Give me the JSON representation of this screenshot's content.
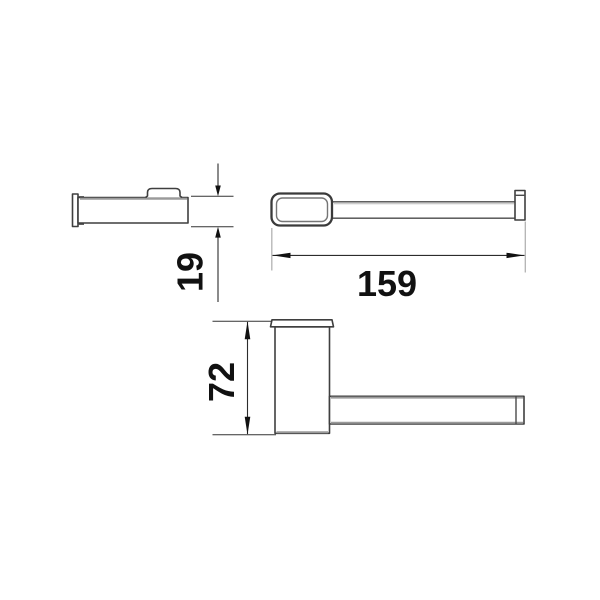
{
  "drawing": {
    "type": "technical-dimension-drawing",
    "views": [
      {
        "id": "side-view",
        "description": "side profile of wall bracket with arm"
      },
      {
        "id": "top-view",
        "description": "top view of holder bar with mount plate and end stop"
      },
      {
        "id": "front-view",
        "description": "front view of mount post with horizontal bar"
      }
    ],
    "dimensions": [
      {
        "label": "19",
        "view": "side-view",
        "text_orientation": "rotated-90"
      },
      {
        "label": "159",
        "view": "top-view",
        "text_orientation": "horizontal"
      },
      {
        "label": "72",
        "view": "front-view",
        "text_orientation": "rotated-90"
      }
    ],
    "colors": {
      "background": "#ffffff",
      "outline": "#3f3f3f",
      "outline_light": "#9a9a9a",
      "dimension_line": "#2c2c2c",
      "extension_line_gray": "#b3b3b3",
      "label_text": "#111111"
    }
  }
}
